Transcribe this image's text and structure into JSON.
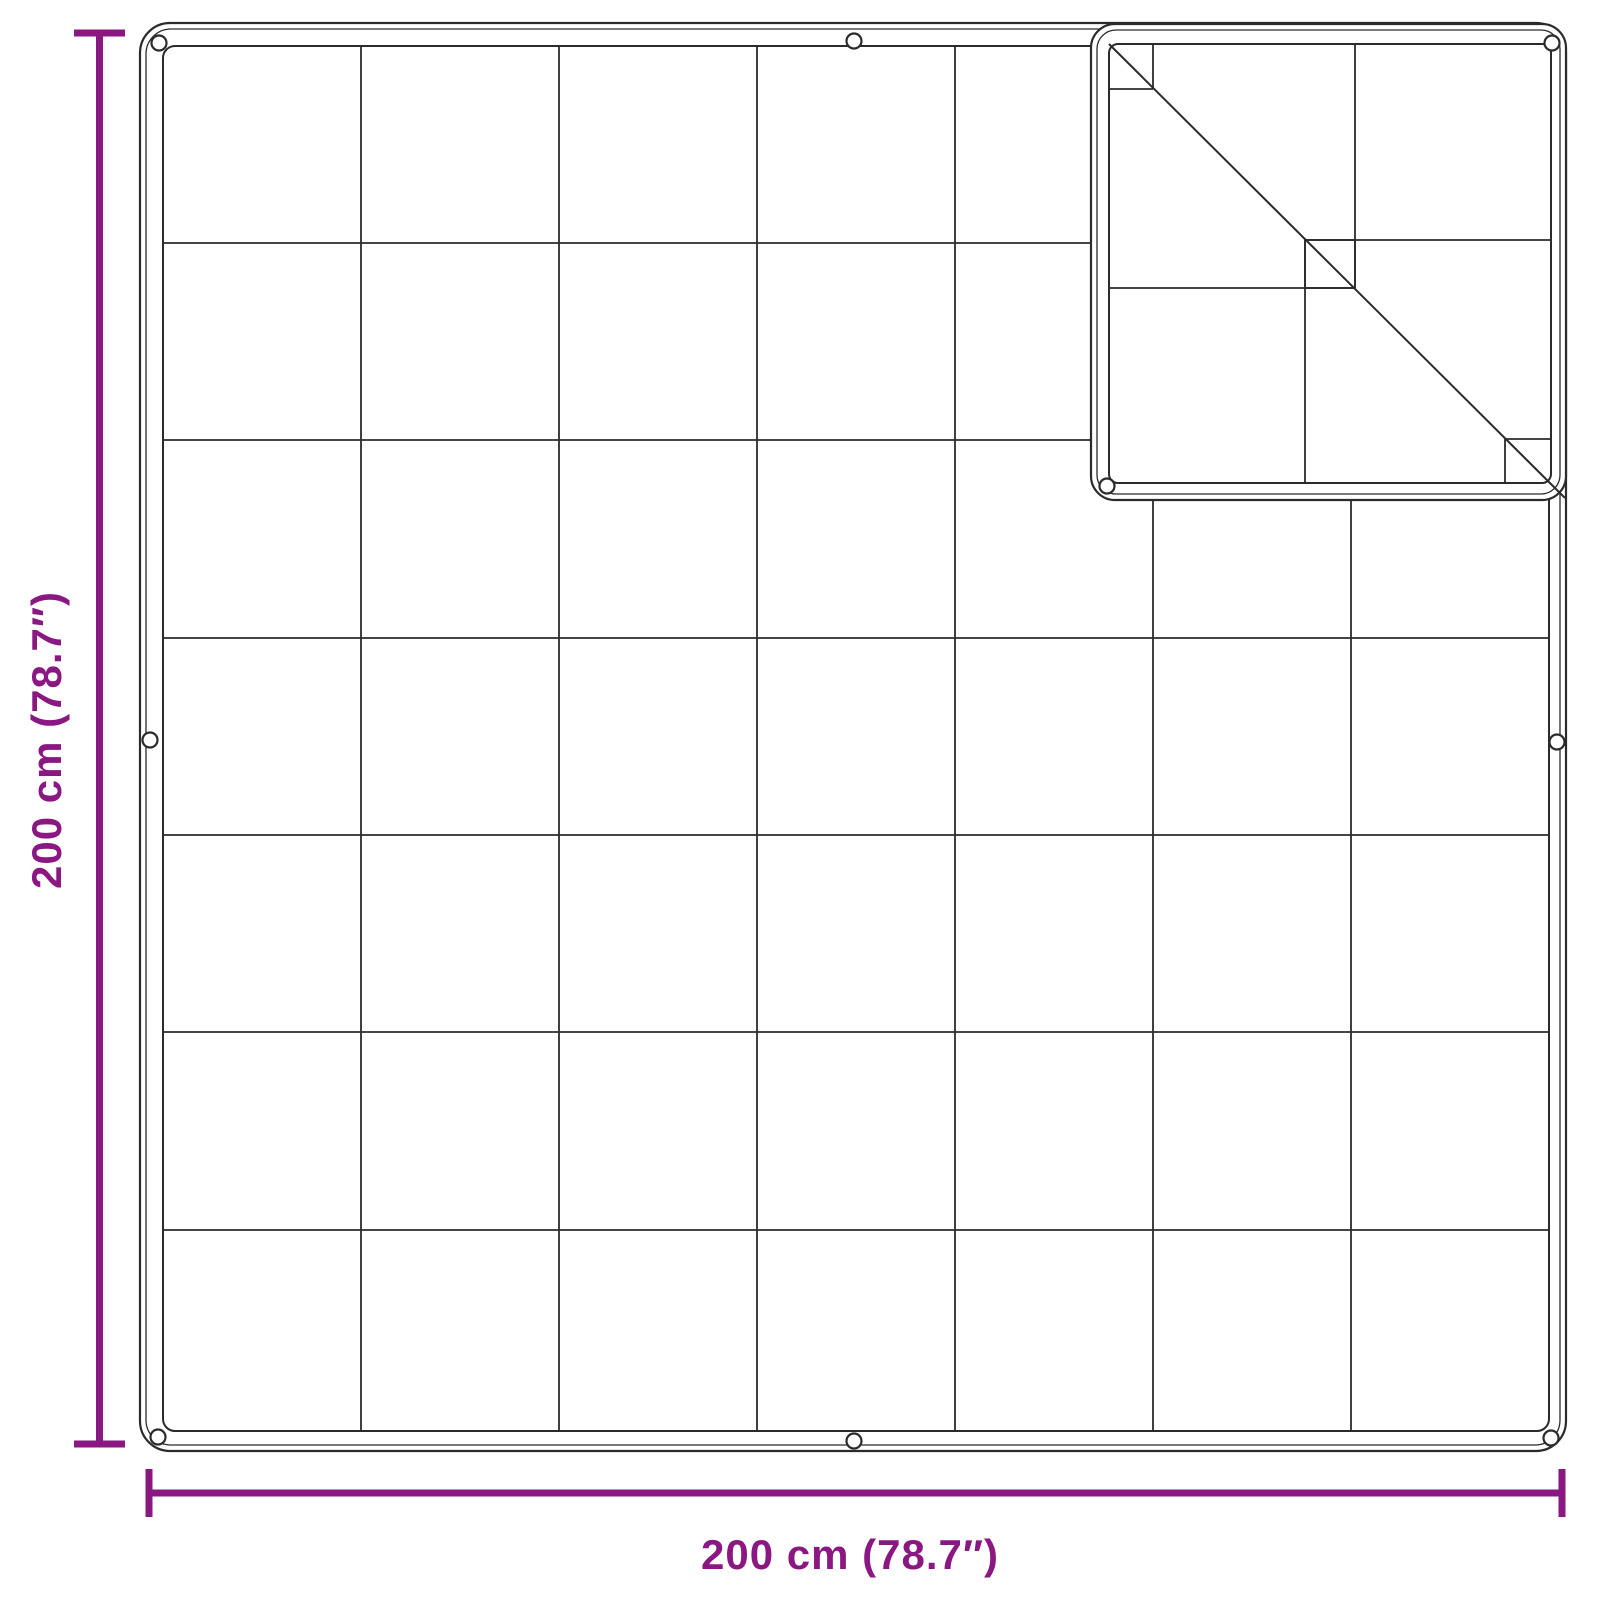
{
  "diagram": {
    "type": "product-dimension-diagram",
    "subject": "square tarp with grommets, quilted grid stitching and magnified corner detail",
    "background_color": "#FFFFFF",
    "outline_color": "#2B2B2B",
    "accent_color": "#8A1782",
    "width_label": "200 cm (78.7″)",
    "height_label": "200 cm (78.7″)",
    "grid": {
      "columns": 7,
      "rows": 7
    },
    "grommets": {
      "main_visible": 7,
      "inset_visible": 2
    }
  }
}
